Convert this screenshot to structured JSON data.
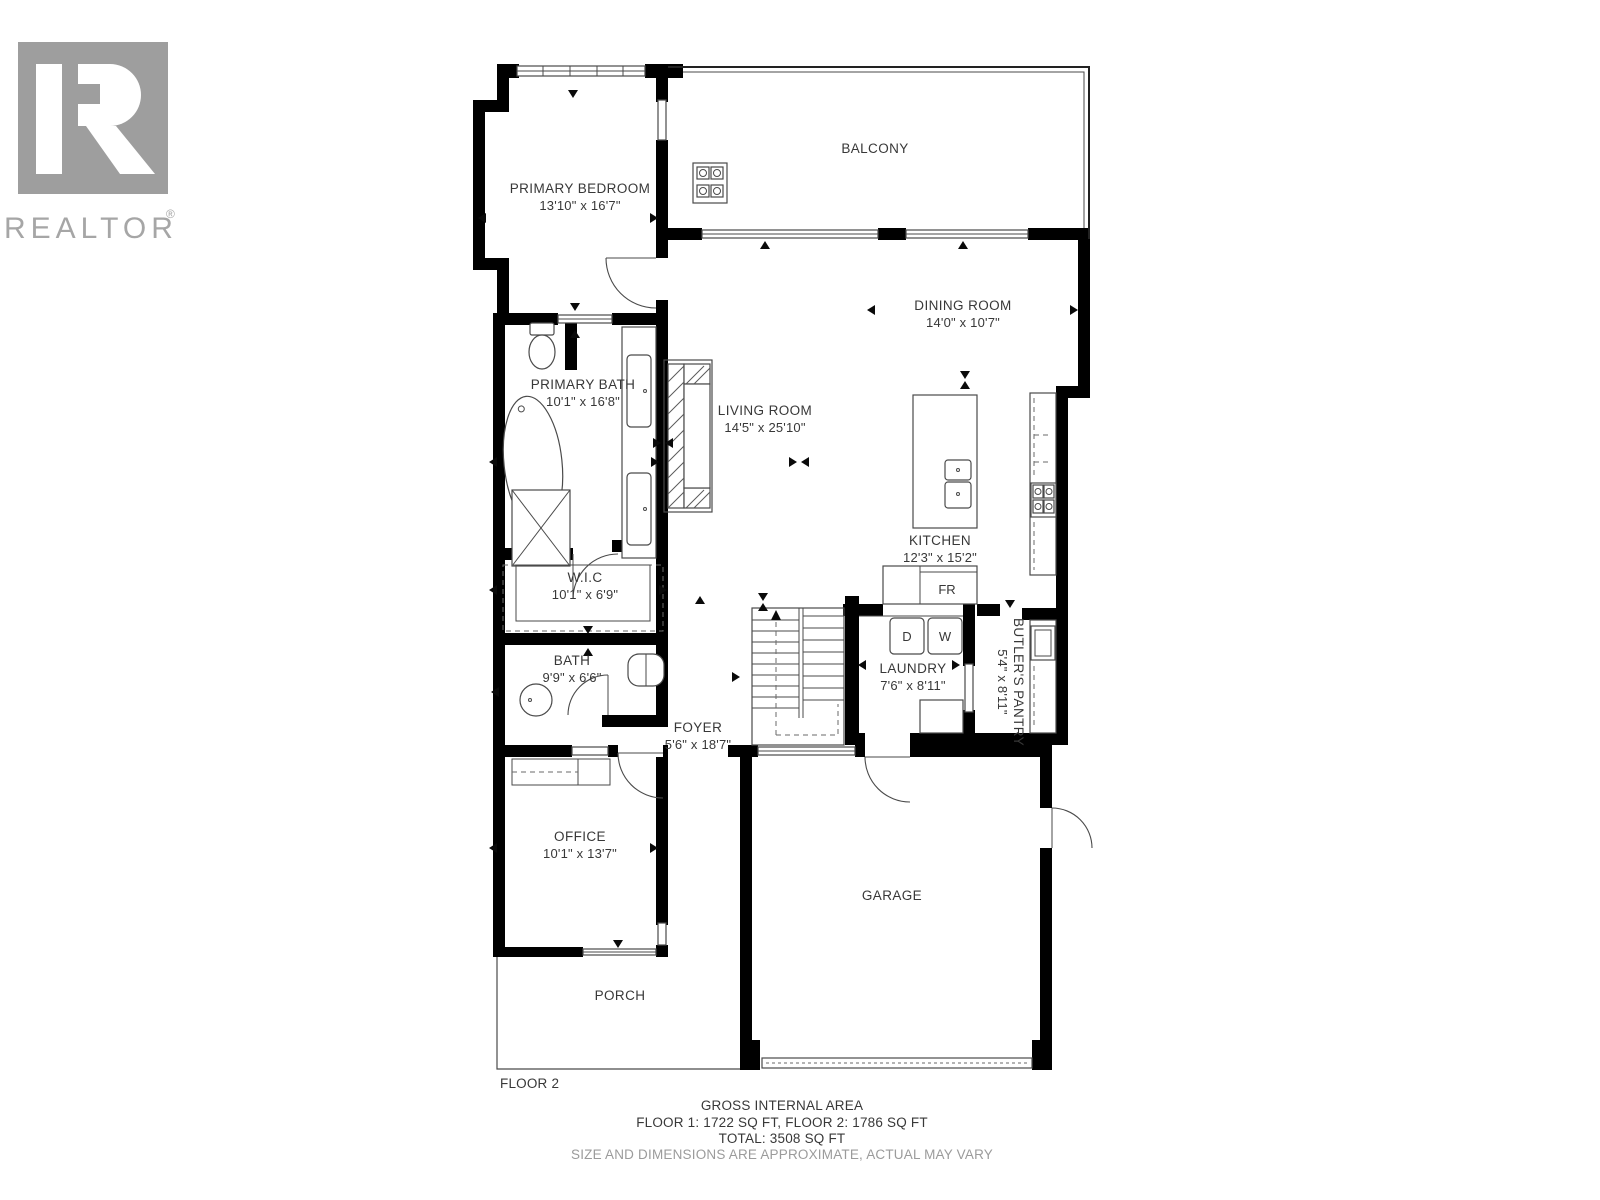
{
  "branding": {
    "name": "REALTOR",
    "registered": "®"
  },
  "plan": {
    "floor_label": "FLOOR 2",
    "rooms": {
      "primary_bedroom": {
        "name": "PRIMARY BEDROOM",
        "dims": "13'10\" x 16'7\""
      },
      "balcony": {
        "name": "BALCONY",
        "dims": ""
      },
      "dining_room": {
        "name": "DINING ROOM",
        "dims": "14'0\" x 10'7\""
      },
      "living_room": {
        "name": "LIVING ROOM",
        "dims": "14'5\" x 25'10\""
      },
      "kitchen": {
        "name": "KITCHEN",
        "dims": "12'3\" x 15'2\""
      },
      "primary_bath": {
        "name": "PRIMARY BATH",
        "dims": "10'1\" x 16'8\""
      },
      "wic": {
        "name": "W.I.C",
        "dims": "10'1\" x 6'9\""
      },
      "bath": {
        "name": "BATH",
        "dims": "9'9\" x 6'6\""
      },
      "foyer": {
        "name": "FOYER",
        "dims": "5'6\" x 18'7\""
      },
      "laundry": {
        "name": "LAUNDRY",
        "dims": "7'6\" x 8'11\""
      },
      "butlers_pantry": {
        "name": "BUTLER'S PANTRY",
        "dims": "5'4\" x 8'11\""
      },
      "office": {
        "name": "OFFICE",
        "dims": "10'1\" x 13'7\""
      },
      "garage": {
        "name": "GARAGE",
        "dims": ""
      },
      "porch": {
        "name": "PORCH",
        "dims": ""
      }
    },
    "appliances": {
      "fridge": "FR",
      "dryer": "D",
      "washer": "W"
    }
  },
  "footer": {
    "title": "GROSS INTERNAL AREA",
    "floors": "FLOOR 1: 1722 SQ FT, FLOOR 2: 1786 SQ FT",
    "total": "TOTAL: 3508 SQ FT",
    "disclaimer": "SIZE AND DIMENSIONS ARE APPROXIMATE, ACTUAL MAY VARY"
  },
  "colors": {
    "wall": "#000000",
    "line": "#4a4a4a",
    "text": "#383838",
    "muted": "#9b9b9b",
    "logo": "#a6a6a6"
  }
}
